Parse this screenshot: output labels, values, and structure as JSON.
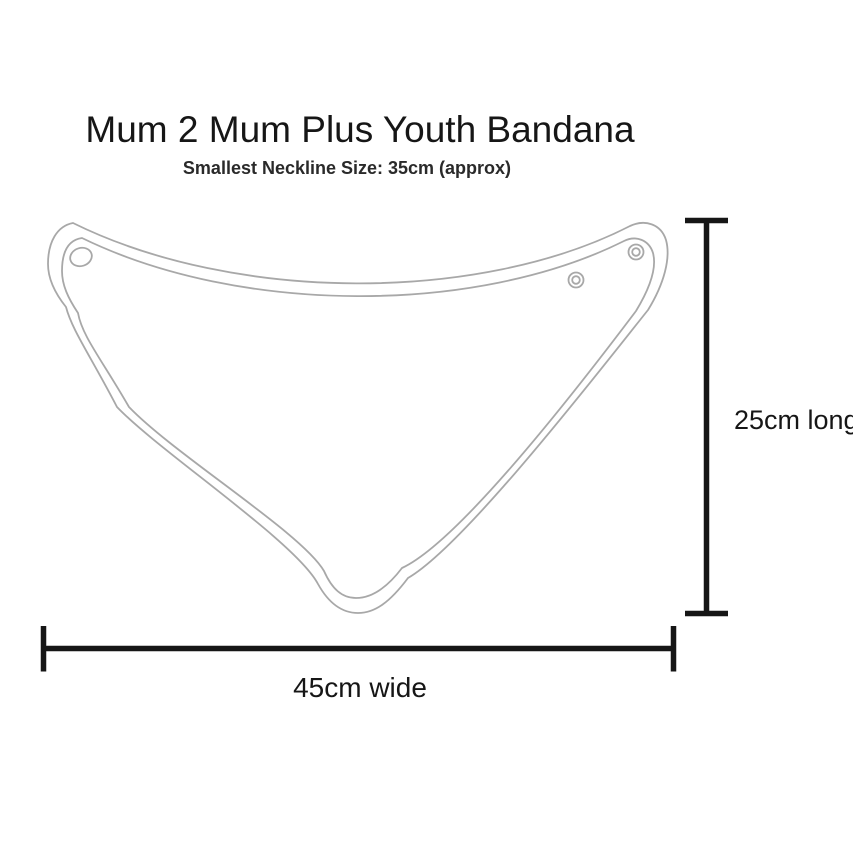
{
  "header": {
    "title": "Mum 2 Mum Plus Youth Bandana",
    "subtitle": "Smallest Neckline Size: 35cm (approx)"
  },
  "diagram": {
    "type": "product-size-diagram",
    "product": "bandana bib outline drawing",
    "colors": {
      "outline_gray": "#a8a8a8",
      "dimension_black": "#161616",
      "background": "#ffffff"
    },
    "snap_buttons": {
      "left_corner_count": 1,
      "right_corner_count": 2
    },
    "dimensions": {
      "length": {
        "label": "25cm long",
        "value_cm": 25,
        "orientation": "vertical"
      },
      "width": {
        "label": "45cm wide",
        "value_cm": 45,
        "orientation": "horizontal"
      },
      "neckline_smallest": {
        "value_cm": 35,
        "approx": true
      }
    }
  }
}
